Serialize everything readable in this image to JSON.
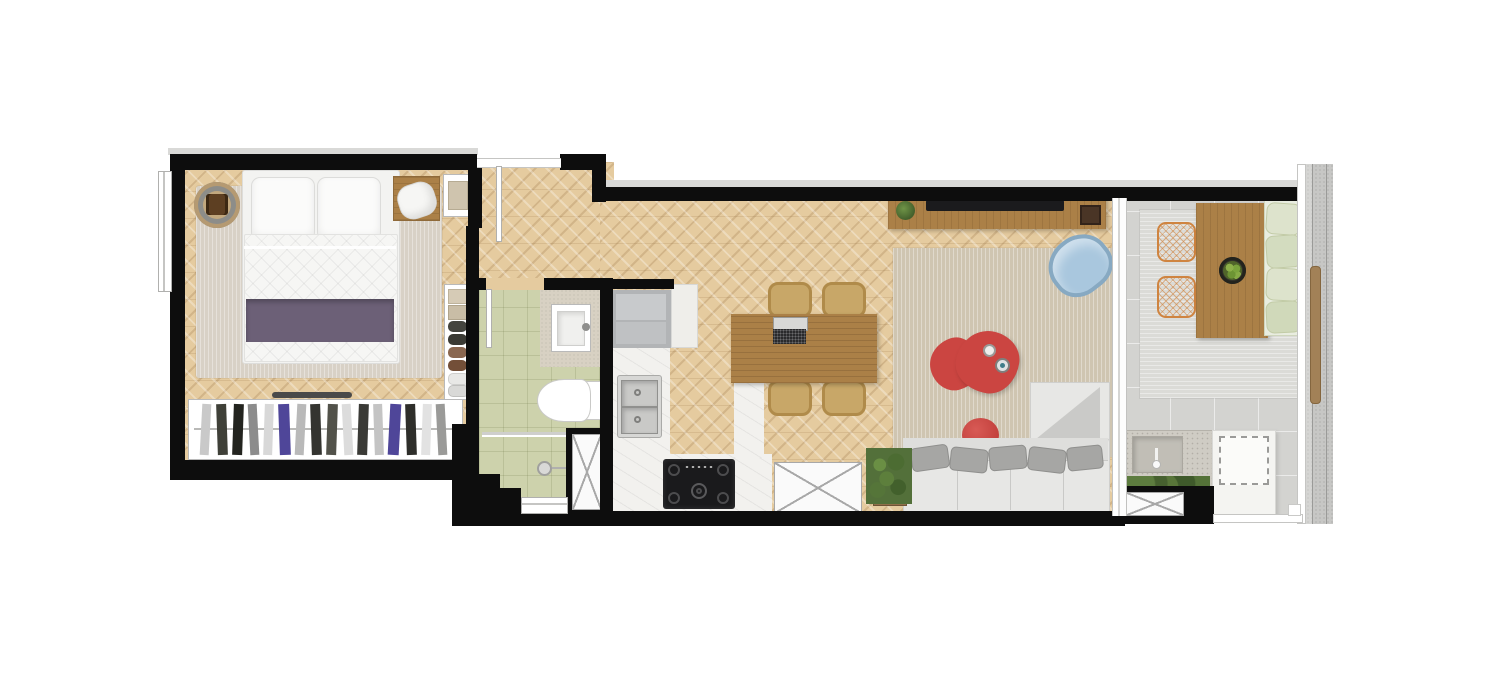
{
  "scene": {
    "type": "apartment-floor-plan",
    "style": "top-down architectural render, studio apartment",
    "background": "#ffffff",
    "canvas": {
      "width": 1500,
      "height": 685
    }
  },
  "colors": {
    "wall": "#0d0d0d",
    "wood_floor": "#e5cb9f",
    "furniture_wood": "#ab8047",
    "marble_counter": "#f2f1ee",
    "bathroom_tile": "#cdd2ac",
    "balcony_paver": "#d3d3d0",
    "rug_bedroom": "#d8d1c6",
    "rug_living": "#cfc5b1",
    "rug_balcony": "#dbdbd7",
    "accent_red": "#cb4541",
    "chair_blue": "#a9c7de",
    "cushion_green": "#dde3cc",
    "chair_orange": "#d0853f",
    "bed_runner_purple": "#6c6077",
    "sofa_gray": "#e7e7e5",
    "plant_green": "#53703a",
    "appliance_black": "#1a1a1c",
    "fridge_gray": "#b2b4b6"
  },
  "rooms": [
    {
      "id": "bedroom",
      "furniture": [
        "double-bed",
        "two-pillows",
        "purple-bed-runner",
        "area-rug",
        "round-side-table",
        "nightstand-with-lamp",
        "tray-side-table",
        "open-closet-shelves",
        "wardrobe-with-hanging-clothes",
        "window"
      ]
    },
    {
      "id": "bathroom",
      "furniture": [
        "vanity-counter",
        "square-sink",
        "toilet",
        "shower-glass-partition",
        "shower-head",
        "service-shaft",
        "small-window",
        "door"
      ]
    },
    {
      "id": "kitchen",
      "furniture": [
        "refrigerator",
        "l-shaped-marble-counter",
        "double-basin-sink",
        "gas-cooktop",
        "counter-peninsula",
        "service-shaft"
      ]
    },
    {
      "id": "hallway",
      "furniture": [
        "entry-door"
      ]
    },
    {
      "id": "living-dining",
      "furniture": [
        "dining-table",
        "laptop",
        "four-rattan-chairs",
        "tv-sideboard",
        "tv",
        "small-plant",
        "dark-tray",
        "area-rug",
        "blue-lounge-chair",
        "two-red-coffee-tables",
        "red-pouf",
        "l-shaped-gray-sofa",
        "five-gray-pillows",
        "gray-throw",
        "floor-plant"
      ]
    },
    {
      "id": "balcony",
      "furniture": [
        "sliding-glass-door",
        "outdoor-rug",
        "outdoor-wood-table",
        "fruit-bowl",
        "two-orange-wire-chairs",
        "green-cushion-sofa",
        "outdoor-counter-with-sink",
        "faucet",
        "planter-greenery",
        "white-cabinet-dashed-outline",
        "service-shaft",
        "glass-railing",
        "facade-ledge-with-wood-plank"
      ]
    }
  ],
  "symbols": {
    "shaft_x_boxes": 3,
    "door_leaves": 3,
    "windows": 2,
    "dashed_outline_boxes": 1
  }
}
